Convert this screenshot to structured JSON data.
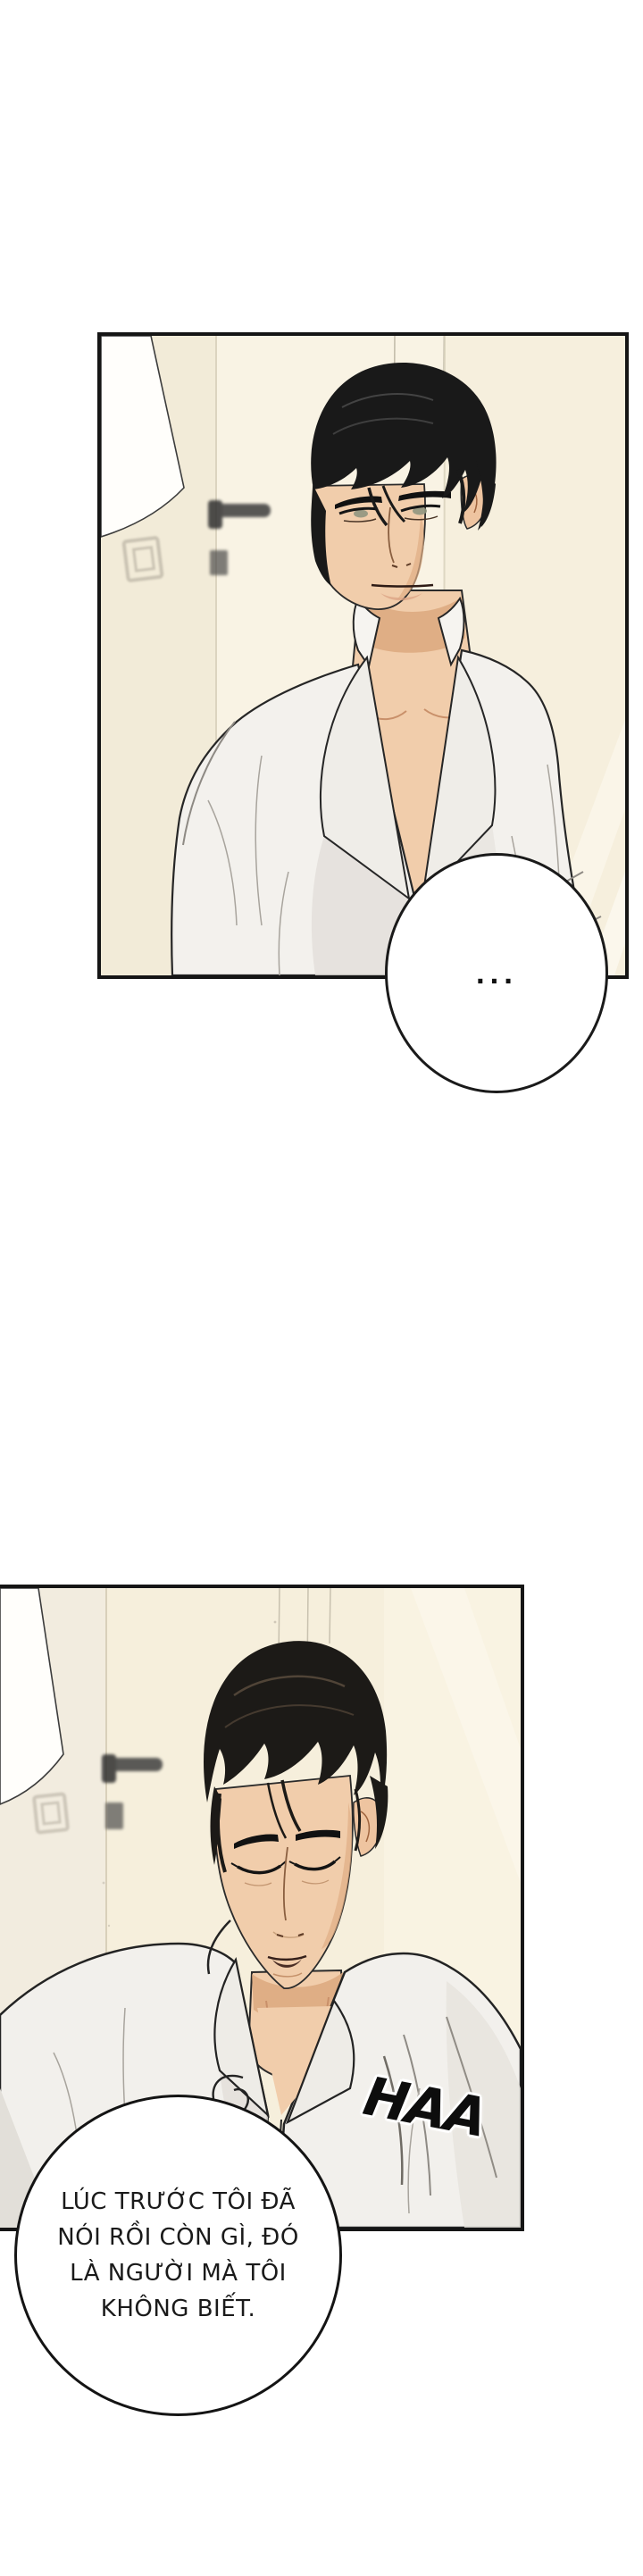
{
  "comic": {
    "panel1": {
      "speech_bubble": {
        "text": "..."
      }
    },
    "panel2": {
      "sfx": "HAA",
      "speech_bubble": {
        "lines": [
          "LÚC TRƯỚC TÔI ĐÃ",
          "NÓI RỒI CÒN GÌ, ĐÓ",
          "LÀ NGƯỜI MÀ TÔI",
          "KHÔNG BIẾT."
        ]
      }
    },
    "colors": {
      "page_bg": "#ffffff",
      "panel_border": "#151515",
      "wall": "#f5eedc",
      "door": "#f9f3e4",
      "skin": "#f1cdab",
      "skin_shadow": "#dfae85",
      "hair": "#1b1916",
      "shirt": "#f3f1ed",
      "shirt_shadow": "#e2dfd9",
      "bubble_fill": "#ffffff",
      "bubble_stroke": "#1a1a1a",
      "dialogue_text": "#1a1a1a"
    }
  }
}
